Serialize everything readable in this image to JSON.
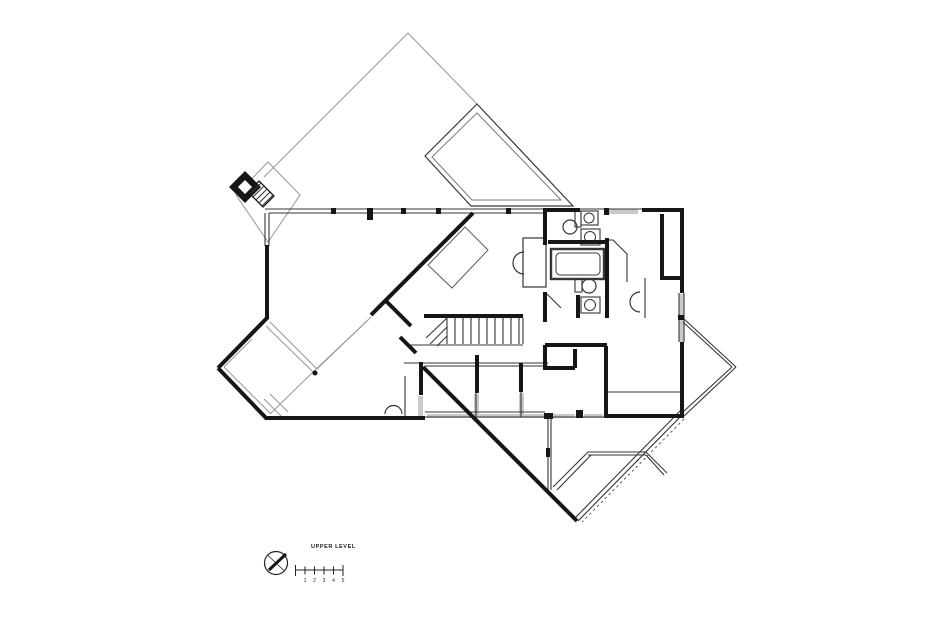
{
  "colors": {
    "ink": "#161616",
    "thin": "#353535",
    "faint": "#979797",
    "window": "#c9c9c9",
    "bg": "#ffffff"
  },
  "footer": {
    "label": "UPPER LEVEL",
    "north_icon": "north-arrow",
    "scale_labels": [
      "1",
      "2",
      "3",
      "4",
      "5"
    ]
  },
  "plan": {
    "width": 932,
    "height": 634,
    "window_bands": [
      [
        605,
        209,
        33,
        5
      ],
      [
        679,
        294,
        5,
        48
      ],
      [
        427,
        414,
        117,
        4
      ],
      [
        553,
        414,
        22,
        4
      ],
      [
        584,
        414,
        19,
        4
      ],
      [
        418,
        396,
        5,
        21
      ],
      [
        474,
        394,
        5,
        22
      ],
      [
        519,
        393,
        5,
        23
      ]
    ],
    "faint_lines": [
      [
        408,
        33,
        264,
        177
      ],
      [
        408,
        33,
        477,
        104
      ],
      [
        270,
        322,
        317,
        369
      ],
      [
        266,
        326,
        313,
        372
      ],
      [
        317,
        369,
        371,
        317
      ],
      [
        313,
        372,
        368,
        320
      ],
      [
        252,
        339,
        224,
        367
      ],
      [
        224,
        367,
        271,
        414
      ],
      [
        271,
        413,
        313,
        372
      ],
      [
        264,
        399,
        283,
        418
      ],
      [
        270,
        394,
        288,
        412
      ]
    ],
    "polygons": [
      {
        "pts": "268,162 300,195 268,242 236,195",
        "fill": "none",
        "stroke": "#979797",
        "sw": 1,
        "name": "chimney-enclosure-outline"
      },
      {
        "pts": "477,104 425,156 471,206 573,206",
        "fill": "none",
        "stroke": "#3a3a3a",
        "sw": 1.2,
        "name": "skylight-outline"
      },
      {
        "pts": "477,113 432,157 472,200 561,200",
        "fill": "none",
        "stroke": "#7a7a7a",
        "sw": 1,
        "name": "skylight-inner-outline"
      },
      {
        "pts": "248,192 259,181 274,196 263,207",
        "fill": "#ffffff",
        "stroke": "#161616",
        "sw": 1.3,
        "name": "hatched-steps"
      },
      {
        "pts": "245,171 261,187 245,203 229,187",
        "fill": "#161616",
        "stroke": "none",
        "sw": 0,
        "name": "chimney-flue"
      },
      {
        "pts": "245,180 252,187 245,194 238,187",
        "fill": "#ffffff",
        "stroke": "none",
        "sw": 0,
        "name": "chimney-flue-core"
      },
      {
        "pts": "428,265 465,227 488,250 452,288",
        "fill": "none",
        "stroke": "#5a5a5a",
        "sw": 1,
        "name": "loft-bed-outline"
      }
    ],
    "thin_lines": [
      [
        265,
        209,
        684,
        209
      ],
      [
        269,
        213,
        543,
        213
      ],
      [
        265,
        213,
        265,
        246
      ],
      [
        269,
        213,
        269,
        246
      ],
      [
        679,
        293,
        679,
        342
      ],
      [
        684,
        293,
        684,
        342
      ],
      [
        447,
        318,
        447,
        344
      ],
      [
        455,
        318,
        455,
        344
      ],
      [
        463,
        318,
        463,
        344
      ],
      [
        471,
        318,
        471,
        344
      ],
      [
        479,
        318,
        479,
        344
      ],
      [
        487,
        318,
        487,
        344
      ],
      [
        495,
        318,
        495,
        344
      ],
      [
        503,
        318,
        503,
        344
      ],
      [
        511,
        318,
        511,
        344
      ],
      [
        519,
        318,
        519,
        344
      ],
      [
        523,
        318,
        523,
        344
      ],
      [
        410,
        345,
        523,
        345
      ],
      [
        447,
        318,
        426,
        338
      ],
      [
        447,
        327,
        430,
        344
      ],
      [
        447,
        336,
        437,
        346
      ],
      [
        425,
        363,
        548,
        363
      ],
      [
        425,
        366,
        548,
        366
      ],
      [
        476,
        393,
        476,
        417
      ],
      [
        521,
        392,
        521,
        417
      ],
      [
        425,
        412,
        545,
        412
      ],
      [
        425,
        417,
        604,
        417
      ],
      [
        404,
        363,
        425,
        363
      ],
      [
        405,
        376,
        405,
        417
      ],
      [
        548,
        417,
        548,
        490
      ],
      [
        551,
        417,
        551,
        490
      ],
      [
        608,
        392,
        681,
        392
      ],
      [
        645,
        278,
        645,
        318
      ],
      [
        683,
        318,
        736,
        367
      ],
      [
        736,
        367,
        683,
        417
      ],
      [
        683,
        322,
        732,
        367
      ],
      [
        732,
        367,
        683,
        412
      ],
      [
        578,
        521,
        684,
        413
      ],
      [
        575,
        518,
        681,
        410
      ],
      [
        588,
        452,
        646,
        452
      ],
      [
        588,
        455,
        646,
        455
      ],
      [
        588,
        452,
        553,
        487
      ],
      [
        591,
        455,
        557,
        490
      ],
      [
        646,
        452,
        667,
        473
      ],
      [
        646,
        455,
        664,
        475
      ],
      [
        547,
        294,
        561,
        308
      ],
      [
        250,
        194,
        261,
        183
      ],
      [
        253,
        197,
        264,
        186
      ],
      [
        256,
        200,
        267,
        189
      ],
      [
        259,
        203,
        270,
        192
      ],
      [
        262,
        206,
        273,
        195
      ]
    ],
    "polylines": [
      {
        "pts": "607,240 613,240 627,254 627,282",
        "sw": 1.1,
        "name": "vanity-counter"
      }
    ],
    "outline_rects": [
      [
        551,
        249,
        53,
        30,
        2.4
      ],
      [
        556,
        253,
        44,
        22,
        1,
        4
      ],
      [
        523,
        238,
        23,
        49,
        1.2
      ],
      [
        575,
        211,
        6,
        16,
        1.1
      ],
      [
        581,
        211,
        17,
        14,
        1.1
      ],
      [
        581,
        229,
        19,
        16,
        1.1
      ],
      [
        575,
        279,
        7,
        13,
        1.1
      ],
      [
        581,
        297,
        19,
        16,
        1.1
      ]
    ],
    "circles": [
      [
        570,
        227,
        7,
        1.2
      ],
      [
        589,
        218,
        5,
        1
      ],
      [
        590,
        237,
        5.5,
        1
      ],
      [
        589,
        286,
        7,
        1.2
      ],
      [
        590,
        305,
        5.5,
        1
      ]
    ],
    "paths": [
      {
        "d": "M524,252 a11,11 0 0 0 0,22",
        "sw": 1.2,
        "name": "desk-chair"
      },
      {
        "d": "M385,414 a8.5,8.5 0 0 1 17,0",
        "sw": 1.2,
        "name": "basin"
      },
      {
        "d": "M640,312 a10,10 0 0 1 0,-20",
        "sw": 1.2,
        "name": "basin"
      }
    ],
    "dashed_lines": [
      [
        684,
        419,
        582,
        522
      ]
    ],
    "thick_walls": [
      [
        267,
        245,
        267,
        319
      ],
      [
        268,
        317,
        218,
        368
      ],
      [
        218,
        368,
        267,
        419
      ],
      [
        265,
        418,
        425,
        418
      ],
      [
        421,
        362,
        421,
        395
      ],
      [
        473,
        213,
        371,
        315
      ],
      [
        386,
        301,
        411,
        326
      ],
      [
        400,
        337,
        416,
        353
      ],
      [
        424,
        316,
        523,
        316
      ],
      [
        423,
        367,
        577,
        521
      ],
      [
        543,
        210,
        580,
        210
      ],
      [
        642,
        210,
        684,
        210
      ],
      [
        682,
        208,
        682,
        293
      ],
      [
        682,
        342,
        682,
        418
      ],
      [
        662,
        214,
        662,
        278
      ],
      [
        660,
        278,
        683,
        278
      ],
      [
        545,
        211,
        545,
        245
      ],
      [
        545,
        292,
        545,
        322
      ],
      [
        545,
        345,
        545,
        370
      ],
      [
        548,
        242,
        607,
        242
      ],
      [
        607,
        238,
        607,
        318
      ],
      [
        578,
        295,
        578,
        318
      ],
      [
        545,
        345,
        607,
        345
      ],
      [
        545,
        368,
        575,
        368
      ],
      [
        575,
        349,
        575,
        368
      ],
      [
        606,
        346,
        606,
        417
      ],
      [
        604,
        416,
        684,
        416
      ],
      [
        477,
        355,
        477,
        393
      ],
      [
        521,
        363,
        521,
        392
      ]
    ],
    "black_blocks": [
      [
        331,
        208,
        5,
        6
      ],
      [
        401,
        208,
        5,
        6
      ],
      [
        436,
        208,
        5,
        6
      ],
      [
        506,
        208,
        5,
        6
      ],
      [
        367,
        208,
        6,
        12
      ],
      [
        604,
        208,
        5,
        7
      ],
      [
        678,
        315,
        6,
        5
      ],
      [
        544,
        413,
        9,
        6
      ],
      [
        576,
        410,
        7,
        8
      ],
      [
        546,
        448,
        4,
        9
      ]
    ],
    "dots": [
      [
        315,
        373,
        2.5
      ]
    ]
  }
}
